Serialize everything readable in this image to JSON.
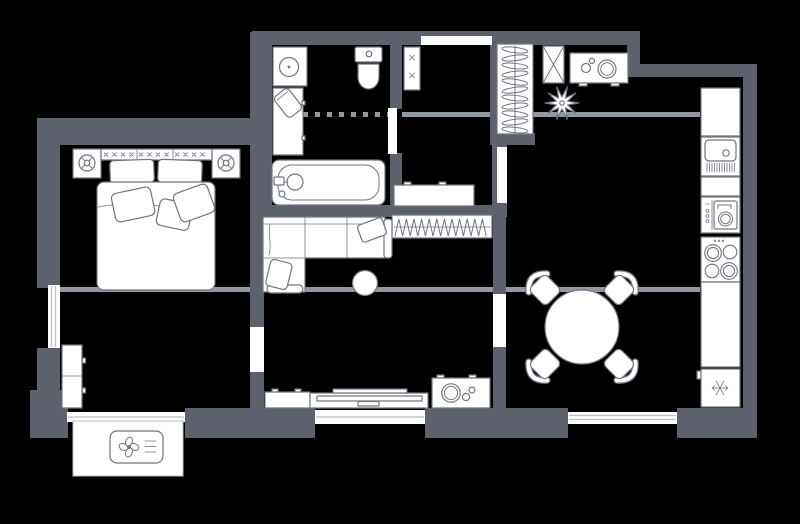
{
  "app": {
    "title": "Apartment floor plan"
  },
  "colors": {
    "background": "#000000",
    "wall": "#5c616b",
    "beam": "#9298a2",
    "furniture_fill": "#ffffff",
    "furniture_stroke": "#70757e",
    "glazing": "#b9bfc7"
  },
  "plan": {
    "rooms": [
      {
        "name": "bedroom"
      },
      {
        "name": "bathroom"
      },
      {
        "name": "hallway"
      },
      {
        "name": "living-room"
      },
      {
        "name": "kitchen-dining"
      },
      {
        "name": "study"
      },
      {
        "name": "balcony"
      }
    ],
    "furniture": [
      "double-bed",
      "nightstand-left",
      "nightstand-right",
      "table-lamp-left",
      "table-lamp-right",
      "headboard",
      "study-cabinet",
      "washbasin",
      "bathroom-cabinet",
      "laundry-basket",
      "toilet",
      "bathtub",
      "shower-screen-dashed",
      "utility-shelf",
      "hall-sideboard",
      "shoe-rack",
      "wardrobe-with-hangers",
      "mirror-cabinet",
      "entry-console",
      "plant",
      "kitchen-counter",
      "kitchen-sink",
      "oven",
      "cooktop",
      "fridge-freezer",
      "corner-sofa",
      "coffee-table",
      "media-cabinet",
      "tv-bench",
      "tv",
      "decor-console",
      "dining-table",
      "dining-chair",
      "balcony-slab",
      "air-conditioner"
    ],
    "icons": [
      "lamp-icon",
      "x-cross-icon",
      "hanger-icon",
      "plant-icon",
      "snowflake-icon",
      "fan-icon",
      "burner-icon",
      "drainboard-icon"
    ]
  }
}
